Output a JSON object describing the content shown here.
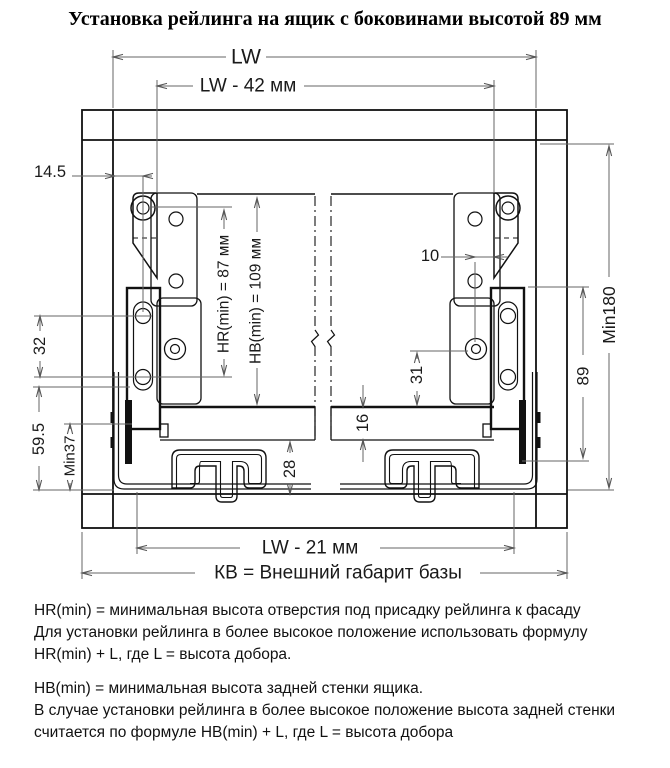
{
  "title": "Установка рейлинга на ящик с боковинами высотой 89 мм",
  "drawing": {
    "dim_labels": {
      "lw": "LW",
      "lw42": "LW - 42 мм",
      "d145": "14.5",
      "d10": "10",
      "hr": "HR(min) = 87 мм",
      "hb": "HB(min) = 109 мм",
      "min180": "Min180",
      "d89": "89",
      "d32": "32",
      "d595": "59.5",
      "min37": "Min37",
      "d31": "31",
      "d16": "16",
      "d28": "28",
      "lw21": "LW - 21 мм",
      "kv": "КВ = Внешний габарит базы"
    }
  },
  "notes": {
    "hr_note_lines": [
      "HR(min) = минимальная высота отверстия под присадку рейлинга к фасаду",
      "Для установки рейлинга в более высокое положение использовать формулу",
      "HR(min) + L,  где L = высота добора."
    ],
    "hb_note_lines": [
      "HB(min) = минимальная высота задней стенки ящика.",
      "В случае установки рейлинга в более высокое положение высота задней стенки",
      "считается по формуле HB(min) + L, где L = высота добора"
    ]
  }
}
